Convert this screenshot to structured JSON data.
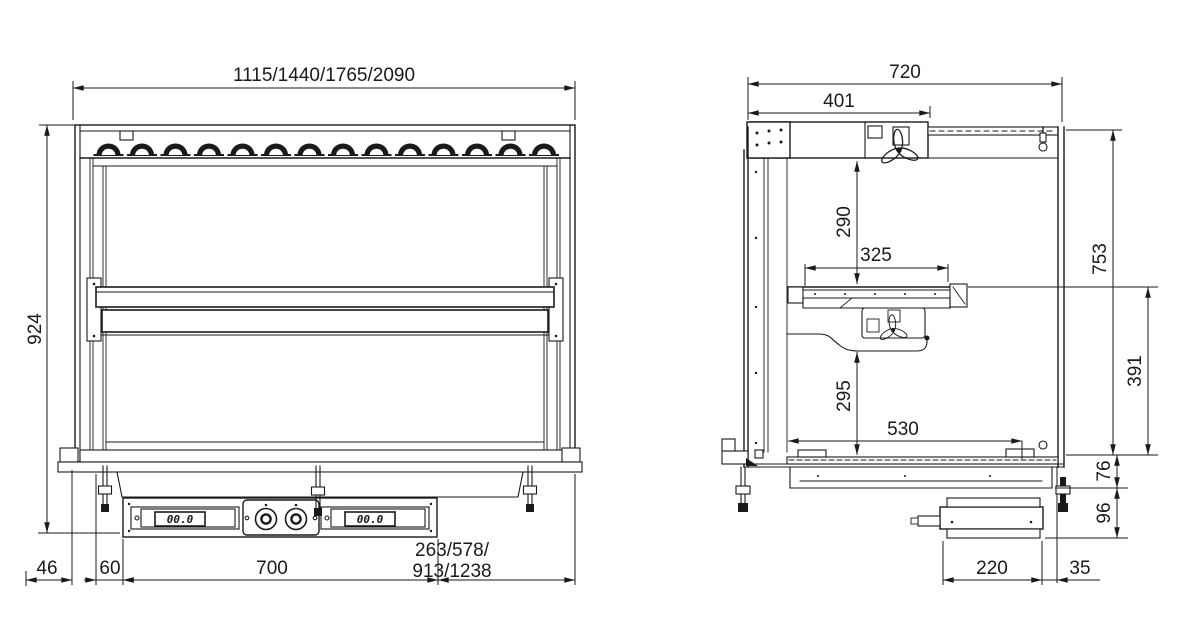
{
  "front_view": {
    "dims": {
      "top_width": "1115/1440/1765/2090",
      "height": "924",
      "bottom_left": "46",
      "bottom_inner": "60",
      "panel_width": "700",
      "bottom_right_line1": "263/578/",
      "bottom_right_line2": "913/1238"
    },
    "control_panel": {
      "left_display": "00.0",
      "right_display": "00.0"
    }
  },
  "side_view": {
    "dims": {
      "total_depth": "720",
      "canopy_depth": "401",
      "upper_height": "290",
      "shelf_depth": "325",
      "total_height": "753",
      "well_height": "391",
      "lower_height": "295",
      "well_depth": "530",
      "flange_height": "76",
      "box_height": "96",
      "box_depth": "220",
      "box_offset": "35"
    }
  }
}
